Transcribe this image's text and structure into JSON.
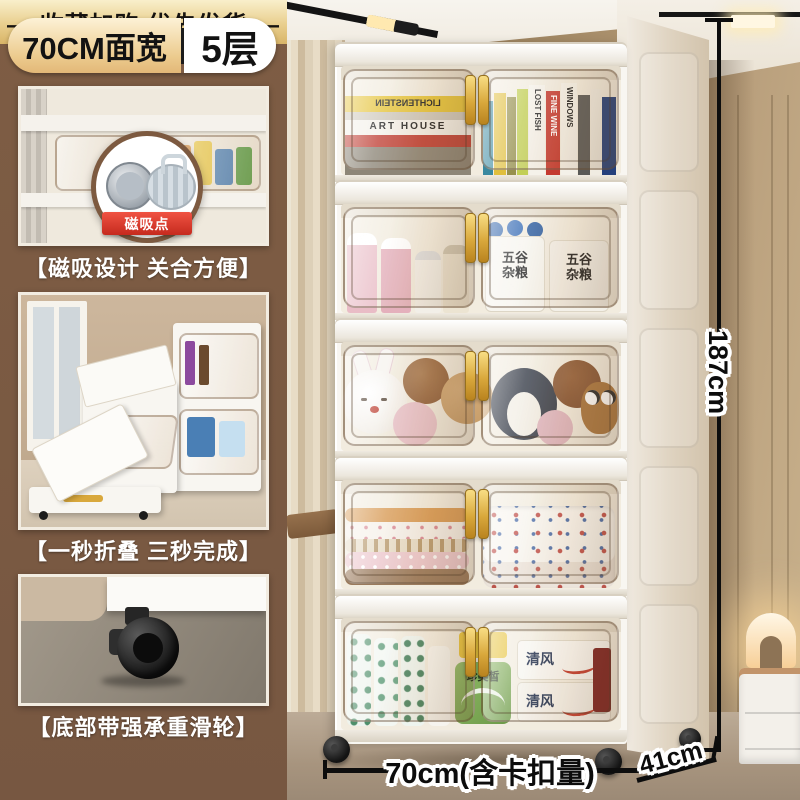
{
  "badge": {
    "width_label": "70CM面宽",
    "tier_label": "5层"
  },
  "features": [
    {
      "caption": "【磁吸设计 关合方便】",
      "inset_badge": "磁吸点"
    },
    {
      "caption": "【一秒折叠 三秒完成】"
    },
    {
      "caption": "【底部带强承重滑轮】"
    }
  ],
  "banner": {
    "text": "— 收藏加购 优先发货 —"
  },
  "dimensions": {
    "height": "187cm",
    "width": "70cm(含卡扣量)",
    "depth": "41cm"
  },
  "cabinet": {
    "tier_contents": [
      "books",
      "snacks-and-drinks",
      "plush-toys",
      "blankets",
      "tissues"
    ],
    "book_titles": {
      "t1": "LICHTENSTEIN",
      "t2": "ART HOUSE",
      "t3": "LOST FISH",
      "t4": "FINE WINE",
      "t5": "WINDOWS"
    },
    "product_labels": {
      "grains": "五谷杂粮",
      "tissue_brand": "清风",
      "green_pack": "珍美皙"
    }
  },
  "colors": {
    "panel_brown": "#7B5A42",
    "badge_gold": "#ECCB8E",
    "banner_gold": "#E9CF8E",
    "red_label": "#E0392C",
    "handle_gold": "#D9A83C",
    "dimension": "#0D0D0D"
  }
}
